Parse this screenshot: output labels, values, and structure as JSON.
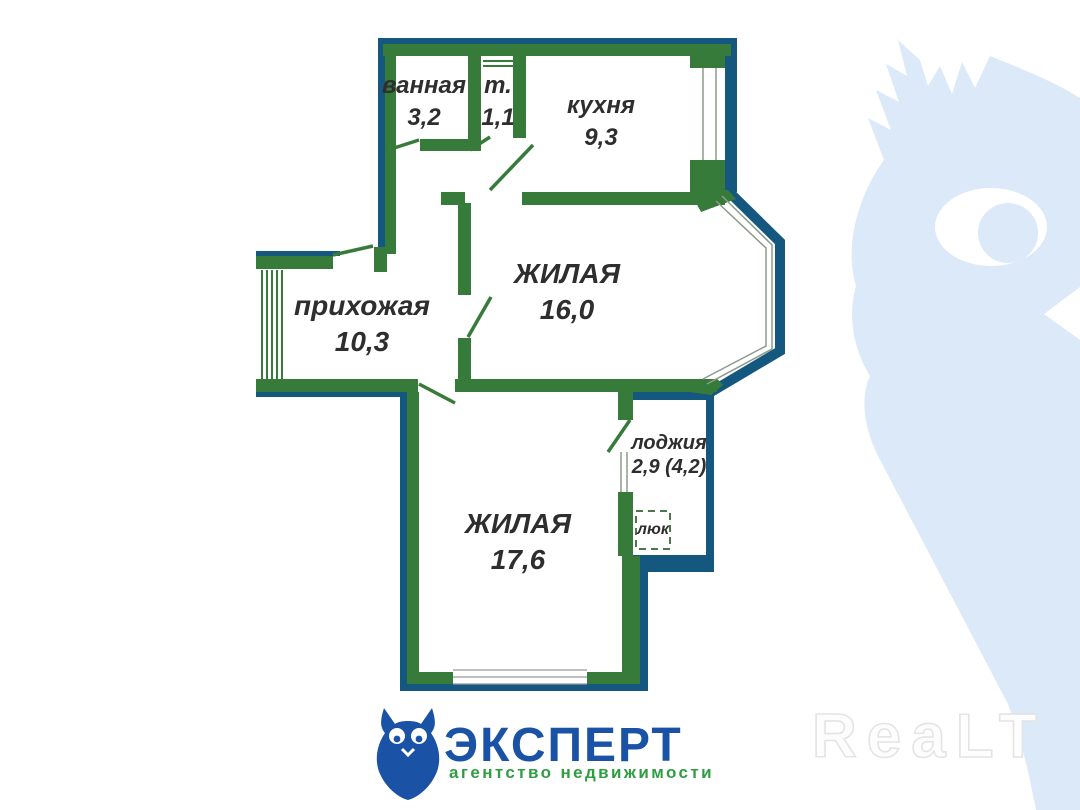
{
  "plan": {
    "rooms": [
      {
        "name": "ванная",
        "area": "3,2"
      },
      {
        "name": "т.",
        "area": "1,1"
      },
      {
        "name": "кухня",
        "area": "9,3"
      },
      {
        "name": "ЖИЛАЯ",
        "area": "16,0"
      },
      {
        "name": "прихожая",
        "area": "10,3"
      },
      {
        "name": "ЖИЛАЯ",
        "area": "17,6"
      },
      {
        "name": "лоджия",
        "area": "2,9 (4,2)"
      },
      {
        "name": "люк",
        "area": ""
      }
    ],
    "colors": {
      "wall_green": "#377B3A",
      "wall_blue": "#14587F",
      "label_text": "#2E2E2E",
      "window_line": "#8B9B8B"
    }
  },
  "branding": {
    "agency_name": "ЭКСПЕРТ",
    "agency_tagline": "агентство недвижимости",
    "logo_blue": "#1A52A5",
    "tagline_green": "#2F9E41"
  },
  "watermarks": {
    "realt_text": "ReaLT",
    "owl_color": "#DCE9F8"
  }
}
